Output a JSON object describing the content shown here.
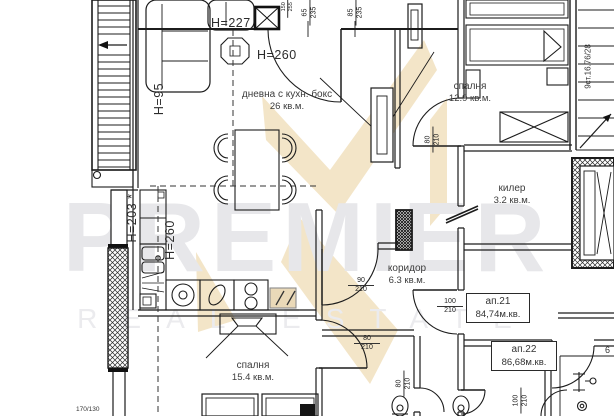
{
  "watermark": {
    "brand": "PREMIER",
    "subtitle": "REAL ESTATE",
    "logo_color": "#f3e5c8",
    "text_color": "#e7e7ea"
  },
  "rooms": [
    {
      "name": "дневна с кухн. бокс",
      "area": "26 кв.м."
    },
    {
      "name": "спалня",
      "area": "12.9 кв.м."
    },
    {
      "name": "килер",
      "area": "3.2 кв.м."
    },
    {
      "name": "коридор",
      "area": "6.3 кв.м."
    },
    {
      "name": "спалня",
      "area": "15.4 кв.м."
    }
  ],
  "apartments": [
    {
      "label": "ап.21",
      "area": "84,74м.кв."
    },
    {
      "label": "ап.22",
      "area": "86,68м.кв."
    }
  ],
  "heights": {
    "h227": "H=227",
    "h260a": "H=260",
    "h95": "H=95",
    "h203": "H=203 *",
    "h260b": "H=260"
  },
  "dims": {
    "d1": {
      "num": "65",
      "den": "235"
    },
    "d2": {
      "num": "85",
      "den": "235"
    },
    "d3": {
      "num": "150",
      "den": "255"
    },
    "d4": {
      "num": "80",
      "den": "210"
    },
    "d5": {
      "num": "90",
      "den": "210"
    },
    "d6": {
      "num": "100",
      "den": "210"
    },
    "d7": {
      "num": "80",
      "den": "210"
    },
    "d8": {
      "num": "80",
      "den": "210"
    },
    "d9": {
      "num": "100",
      "den": "210"
    },
    "d10": "170/130"
  },
  "stairs": {
    "note": "9ст.16.76/28"
  },
  "partial_label": "6"
}
